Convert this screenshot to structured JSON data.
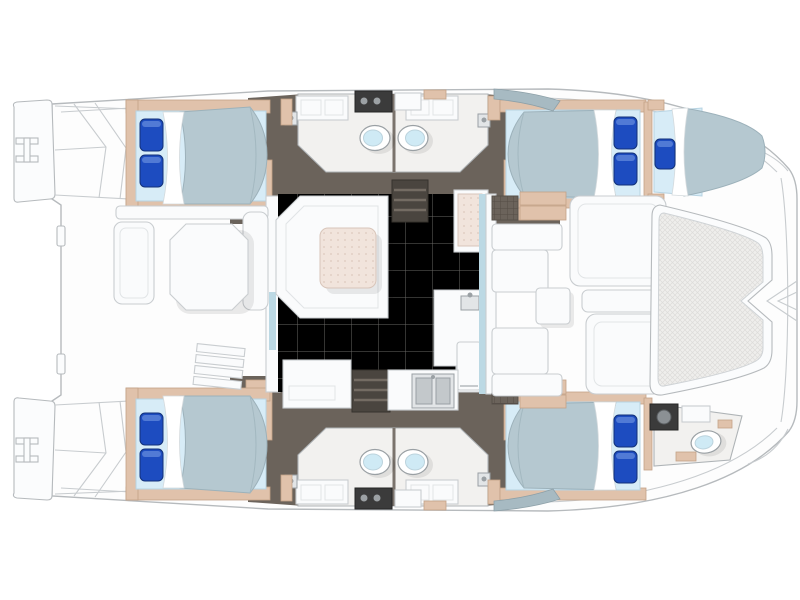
{
  "diagram": {
    "kind": "catamaran-yacht-floor-plan",
    "view": "top-down",
    "bow_direction": "right",
    "stern_direction": "left"
  },
  "inventory": {
    "hulls": 2,
    "double_bed_cabins": 4,
    "forepeak_single_berth": 1,
    "toilets": 5,
    "bathroom_sink_counters": 4,
    "shower_mixers": 4,
    "galley_sink_basins": 2,
    "salon_settee": 1,
    "salon_table": 1,
    "refrigerator_cabinet": 1,
    "companionway_stairs": 2,
    "aft_cockpit_table": 1,
    "forward_cockpit_sunpads": 2,
    "trampoline": 1,
    "swim_transoms": 2,
    "boarding_ladders": 2,
    "bed_pillows": 9
  },
  "palette": {
    "line": "#b6babd",
    "hull": "#fdfdfd",
    "bench": "#fafbfc",
    "benchEdge": "#c9cdd0",
    "salonFloor": "#c9c6c0",
    "tileLine": "#bfbcb6",
    "dark": "#6b635b",
    "darkFloor": "#4a453f",
    "wood": "#e0c2ab",
    "woodEdge": "#c3a287",
    "bedBase": "#d7ecf7",
    "duvet": "#b5c8d0",
    "duvetEdge": "#9cb1ba",
    "sheet": "#ffffff",
    "pillow": "#1d4cc0",
    "pillowEdge": "#123179",
    "pillowHi": "#5b82d8",
    "bathFloor": "#f2f1ef",
    "toiletLid": "#cfeaf5",
    "steel": "#e2e5e7",
    "steelEdge": "#9aa0a4",
    "fabric": "#f1e4dc",
    "fabricDot": "#dcc8bd",
    "fabricEdge": "#d8c5ba",
    "glass": "#bcd9e4",
    "glassDark": "#a7bac2",
    "applianceDark": "#3b3b3b",
    "mesh": "#efeeec",
    "meshLine": "#dddcda"
  }
}
